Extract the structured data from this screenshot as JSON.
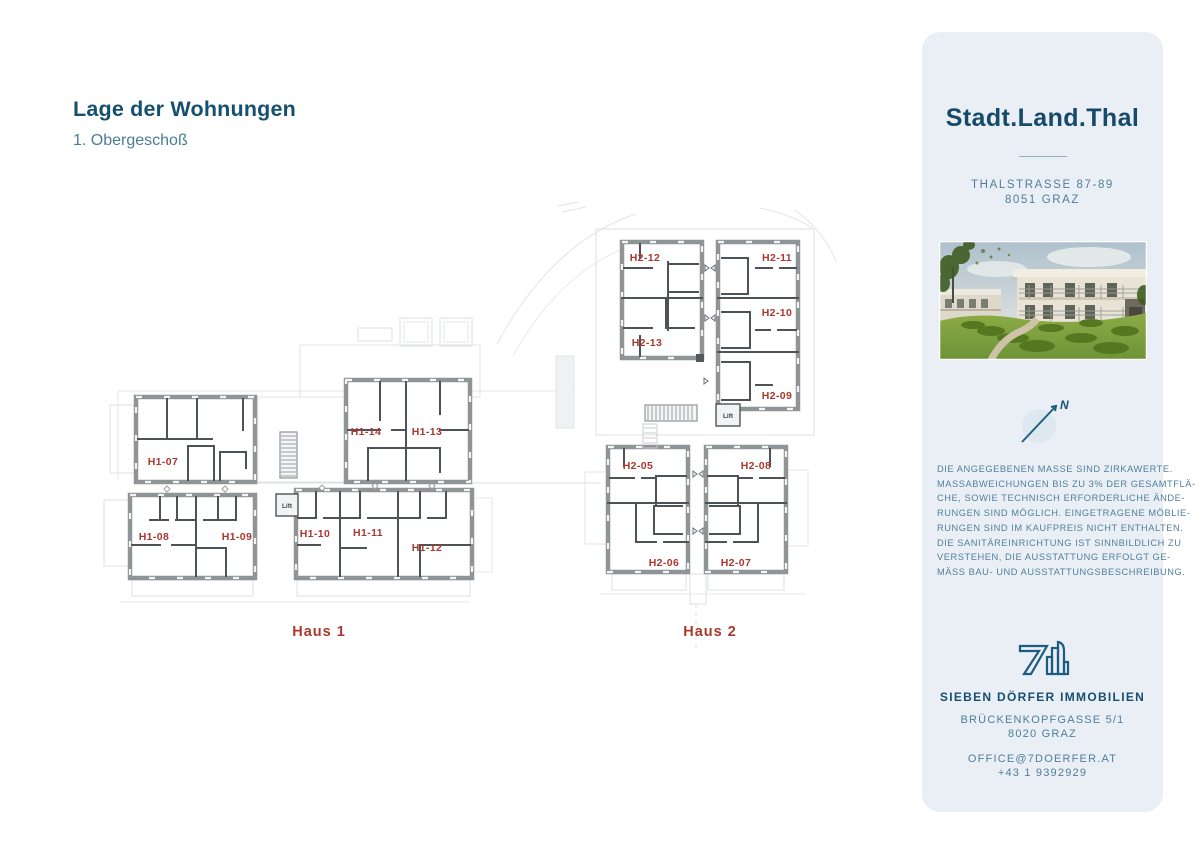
{
  "page": {
    "title": "Lage der Wohnungen",
    "subtitle": "1. Obergeschoß"
  },
  "plan": {
    "haus1": {
      "label": "Haus 1",
      "lift": "Lift",
      "units": [
        {
          "id": "H1-07"
        },
        {
          "id": "H1-08"
        },
        {
          "id": "H1-09"
        },
        {
          "id": "H1-10"
        },
        {
          "id": "H1-11"
        },
        {
          "id": "H1-12"
        },
        {
          "id": "H1-13"
        },
        {
          "id": "H1-14"
        }
      ]
    },
    "haus2": {
      "label": "Haus 2",
      "lift": "Lift",
      "units": [
        {
          "id": "H2-05"
        },
        {
          "id": "H2-06"
        },
        {
          "id": "H2-07"
        },
        {
          "id": "H2-08"
        },
        {
          "id": "H2-09"
        },
        {
          "id": "H2-10"
        },
        {
          "id": "H2-11"
        },
        {
          "id": "H2-12"
        },
        {
          "id": "H2-13"
        }
      ]
    }
  },
  "sidebar": {
    "brand": "Stadt.Land.Thal",
    "address_line1": "THALSTRASSE 87-89",
    "address_line2": "8051 GRAZ",
    "compass": {
      "north_label": "N"
    },
    "disclaimer_lines": [
      "DIE ANGEGEBENEN MASSE SIND ZIRKAWERTE.",
      "MASSABWEICHUNGEN BIS ZU 3% DER GESAMTFLÄ-",
      "CHE, SOWIE TECHNISCH ERFORDERLICHE ÄNDE-",
      "RUNGEN SIND MÖGLICH. EINGETRAGENE MÖBLIE-",
      "RUNGEN SIND IM KAUFPREIS NICHT ENTHALTEN.",
      "DIE SANITÄREINRICHTUNG IST SINNBILDLICH ZU",
      "VERSTEHEN, DIE AUSSTATTUNG ERFOLGT GE-",
      "MÄSS BAU- UND AUSSTATTUNGSBESCHREIBUNG."
    ],
    "company": "SIEBEN DÖRFER IMMOBILIEN",
    "company_address_line1": "BRÜCKENKOPFGASSE 5/1",
    "company_address_line2": "8020 GRAZ",
    "email": "OFFICE@7DOERFER.AT",
    "phone": "+43 1 9392929",
    "colors": {
      "brand_dark": "#164A69",
      "muted_teal": "#527F9B",
      "unit_red": "#AC372E",
      "card_bg": "#E9EFF5"
    }
  }
}
